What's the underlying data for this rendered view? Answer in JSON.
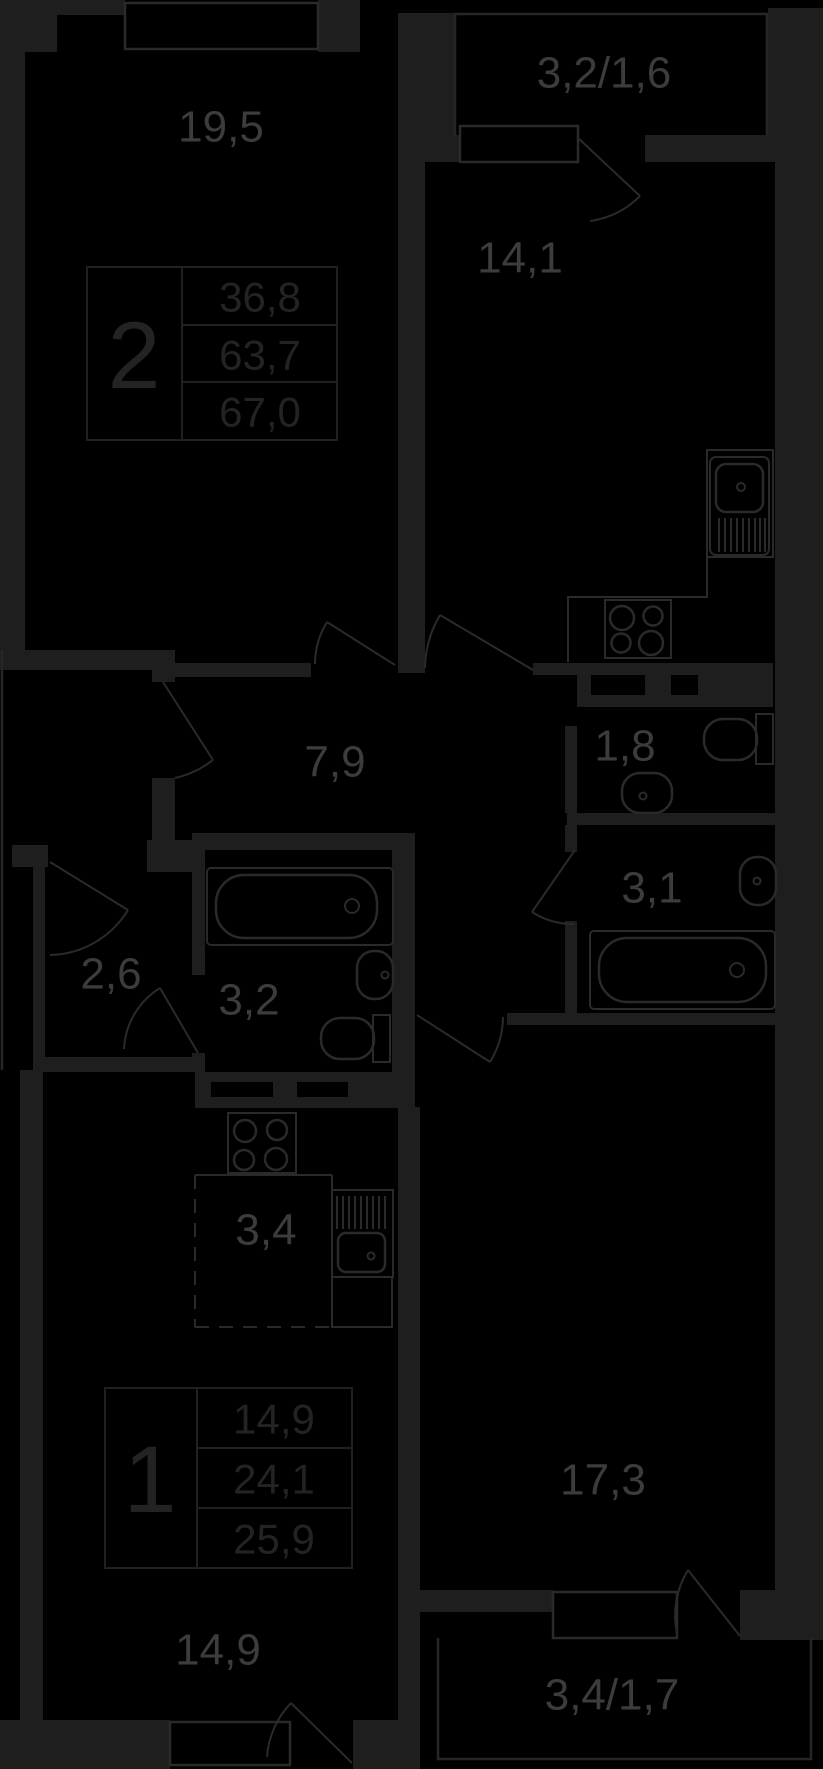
{
  "title": "floor plan of two apartments",
  "colors": {
    "background": "#000000",
    "wall": "#1e1e1e",
    "fixture_line": "#2a2a2a",
    "outline": "#262626",
    "room_label": "#3c3c3c",
    "stamp_text": "#232323"
  },
  "rooms": {
    "bedroom": {
      "area": "19,5"
    },
    "balcony_top": {
      "area": "3,2/1,6"
    },
    "kitchen": {
      "area": "14,1"
    },
    "hallway": {
      "area": "7,9"
    },
    "wc": {
      "area": "1,8"
    },
    "bathroom_apt2": {
      "area": "3,1"
    },
    "hall_apt1": {
      "area": "2,6"
    },
    "bathroom_apt1": {
      "area": "3,2"
    },
    "kitchen_niche": {
      "area": "3,4"
    },
    "living_room": {
      "area": "17,3"
    },
    "room_apt1": {
      "area": "14,9"
    },
    "balcony_bottom": {
      "area": "3,4/1,7"
    }
  },
  "stamps": {
    "apartment_2": {
      "type": "2",
      "living_area": "36,8",
      "area": "63,7",
      "total_area": "67,0"
    },
    "apartment_1": {
      "type": "1",
      "living_area": "14,9",
      "area": "24,1",
      "total_area": "25,9"
    }
  }
}
